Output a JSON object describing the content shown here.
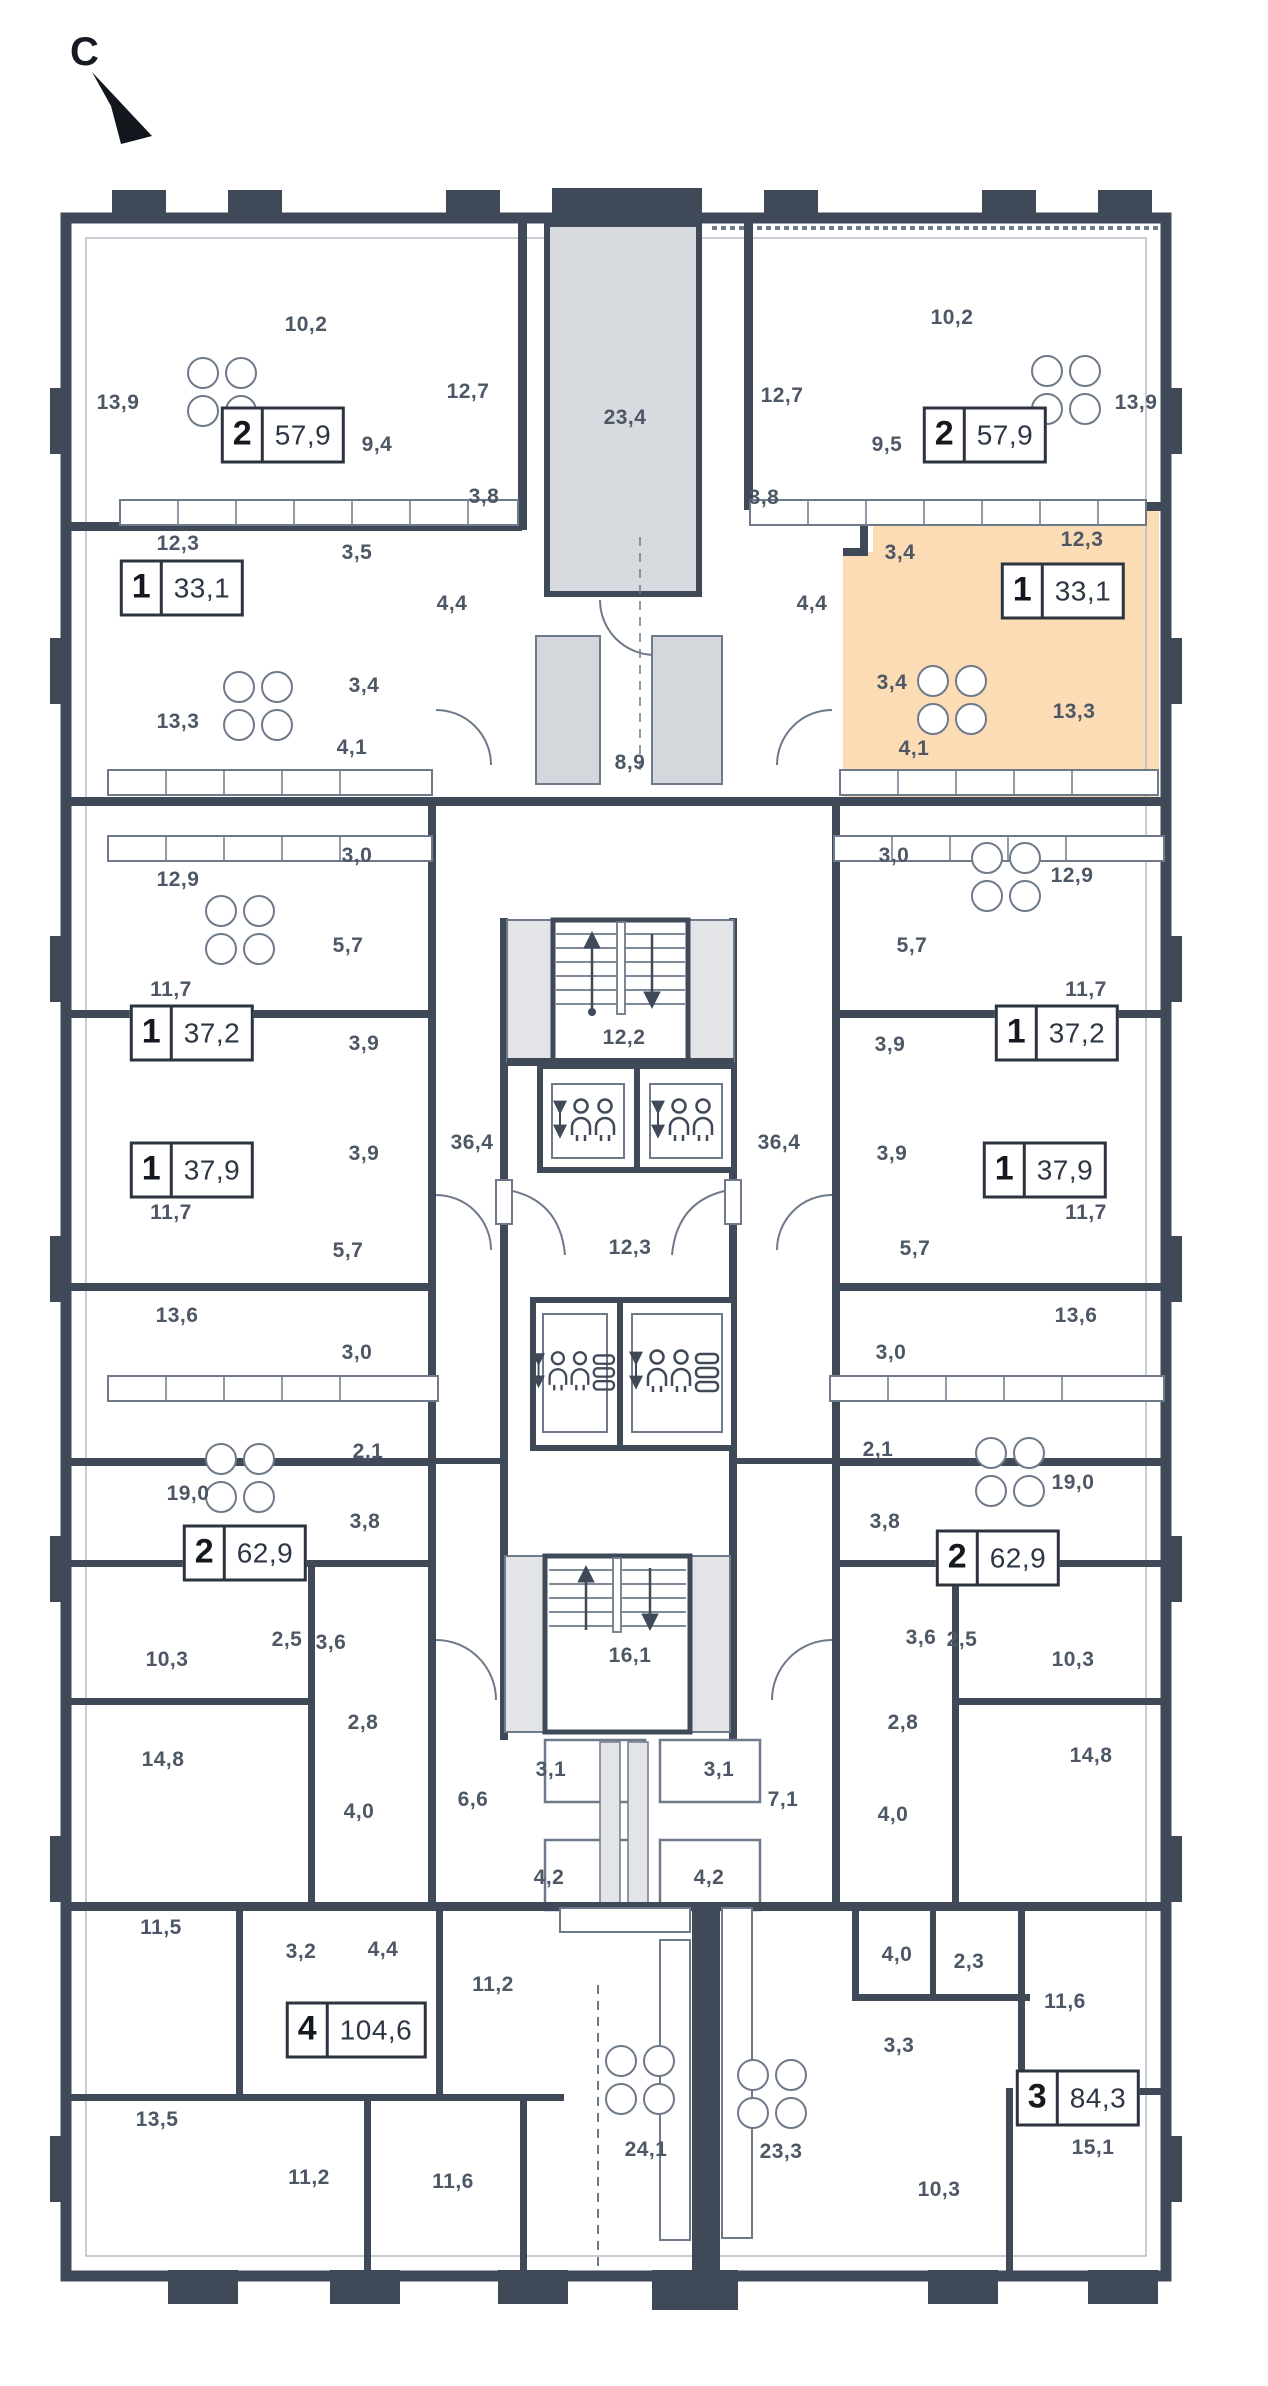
{
  "compass": {
    "letter": "С"
  },
  "colors": {
    "wall": "#3f4958",
    "line": "#6e7a8a",
    "gray_fill": "#d7dadf",
    "highlight": "#fcdcb4",
    "text": "#4d5765"
  },
  "plan": {
    "highlighted_apartment": {
      "rooms": "1",
      "area": "33,1"
    },
    "apartment_badges": [
      {
        "rooms": "2",
        "area": "57,9",
        "x": 283,
        "y": 435,
        "highlighted": false
      },
      {
        "rooms": "2",
        "area": "57,9",
        "x": 985,
        "y": 435,
        "highlighted": false
      },
      {
        "rooms": "1",
        "area": "33,1",
        "x": 182,
        "y": 588,
        "highlighted": false
      },
      {
        "rooms": "1",
        "area": "33,1",
        "x": 1063,
        "y": 591,
        "highlighted": true
      },
      {
        "rooms": "1",
        "area": "37,2",
        "x": 192,
        "y": 1033,
        "highlighted": false
      },
      {
        "rooms": "1",
        "area": "37,2",
        "x": 1057,
        "y": 1033,
        "highlighted": false
      },
      {
        "rooms": "1",
        "area": "37,9",
        "x": 192,
        "y": 1170,
        "highlighted": false
      },
      {
        "rooms": "1",
        "area": "37,9",
        "x": 1045,
        "y": 1170,
        "highlighted": false
      },
      {
        "rooms": "2",
        "area": "62,9",
        "x": 245,
        "y": 1553,
        "highlighted": false
      },
      {
        "rooms": "2",
        "area": "62,9",
        "x": 998,
        "y": 1558,
        "highlighted": false
      },
      {
        "rooms": "4",
        "area": "104,6",
        "x": 356,
        "y": 2030,
        "highlighted": false
      },
      {
        "rooms": "3",
        "area": "84,3",
        "x": 1078,
        "y": 2098,
        "highlighted": false
      }
    ],
    "room_labels": [
      {
        "t": "13,9",
        "x": 118,
        "y": 403
      },
      {
        "t": "10,2",
        "x": 306,
        "y": 325
      },
      {
        "t": "12,7",
        "x": 468,
        "y": 392
      },
      {
        "t": "23,4",
        "x": 625,
        "y": 418
      },
      {
        "t": "12,7",
        "x": 782,
        "y": 396
      },
      {
        "t": "10,2",
        "x": 952,
        "y": 318
      },
      {
        "t": "13,9",
        "x": 1136,
        "y": 403
      },
      {
        "t": "9,4",
        "x": 377,
        "y": 445
      },
      {
        "t": "9,5",
        "x": 887,
        "y": 445
      },
      {
        "t": "3,8",
        "x": 484,
        "y": 497
      },
      {
        "t": "3,8",
        "x": 764,
        "y": 498
      },
      {
        "t": "12,3",
        "x": 178,
        "y": 544
      },
      {
        "t": "3,5",
        "x": 357,
        "y": 553
      },
      {
        "t": "3,4",
        "x": 900,
        "y": 553
      },
      {
        "t": "12,3",
        "x": 1082,
        "y": 540
      },
      {
        "t": "4,4",
        "x": 452,
        "y": 604
      },
      {
        "t": "4,4",
        "x": 812,
        "y": 604
      },
      {
        "t": "3,4",
        "x": 364,
        "y": 686
      },
      {
        "t": "3,4",
        "x": 892,
        "y": 683
      },
      {
        "t": "13,3",
        "x": 178,
        "y": 722
      },
      {
        "t": "13,3",
        "x": 1074,
        "y": 712
      },
      {
        "t": "4,1",
        "x": 352,
        "y": 748
      },
      {
        "t": "4,1",
        "x": 914,
        "y": 749
      },
      {
        "t": "8,9",
        "x": 630,
        "y": 763
      },
      {
        "t": "3,0",
        "x": 357,
        "y": 856
      },
      {
        "t": "3,0",
        "x": 894,
        "y": 856
      },
      {
        "t": "12,9",
        "x": 178,
        "y": 880
      },
      {
        "t": "12,9",
        "x": 1072,
        "y": 876
      },
      {
        "t": "5,7",
        "x": 348,
        "y": 946
      },
      {
        "t": "5,7",
        "x": 912,
        "y": 946
      },
      {
        "t": "11,7",
        "x": 171,
        "y": 990
      },
      {
        "t": "11,7",
        "x": 1086,
        "y": 990
      },
      {
        "t": "3,9",
        "x": 364,
        "y": 1044
      },
      {
        "t": "3,9",
        "x": 890,
        "y": 1045
      },
      {
        "t": "12,2",
        "x": 624,
        "y": 1038
      },
      {
        "t": "36,4",
        "x": 472,
        "y": 1143
      },
      {
        "t": "36,4",
        "x": 779,
        "y": 1143
      },
      {
        "t": "3,9",
        "x": 364,
        "y": 1154
      },
      {
        "t": "3,9",
        "x": 892,
        "y": 1154
      },
      {
        "t": "11,7",
        "x": 171,
        "y": 1213
      },
      {
        "t": "11,7",
        "x": 1086,
        "y": 1213
      },
      {
        "t": "5,7",
        "x": 348,
        "y": 1251
      },
      {
        "t": "5,7",
        "x": 915,
        "y": 1249
      },
      {
        "t": "12,3",
        "x": 630,
        "y": 1248
      },
      {
        "t": "13,6",
        "x": 177,
        "y": 1316
      },
      {
        "t": "13,6",
        "x": 1076,
        "y": 1316
      },
      {
        "t": "3,0",
        "x": 357,
        "y": 1353
      },
      {
        "t": "3,0",
        "x": 891,
        "y": 1353
      },
      {
        "t": "2,1",
        "x": 368,
        "y": 1452
      },
      {
        "t": "2,1",
        "x": 878,
        "y": 1450
      },
      {
        "t": "19,0",
        "x": 188,
        "y": 1494
      },
      {
        "t": "19,0",
        "x": 1073,
        "y": 1483
      },
      {
        "t": "3,8",
        "x": 365,
        "y": 1522
      },
      {
        "t": "3,8",
        "x": 885,
        "y": 1522
      },
      {
        "t": "2,5",
        "x": 287,
        "y": 1640
      },
      {
        "t": "2,5",
        "x": 962,
        "y": 1640
      },
      {
        "t": "3,6",
        "x": 331,
        "y": 1643
      },
      {
        "t": "3,6",
        "x": 921,
        "y": 1638
      },
      {
        "t": "10,3",
        "x": 167,
        "y": 1660
      },
      {
        "t": "10,3",
        "x": 1073,
        "y": 1660
      },
      {
        "t": "16,1",
        "x": 630,
        "y": 1656
      },
      {
        "t": "2,8",
        "x": 363,
        "y": 1723
      },
      {
        "t": "2,8",
        "x": 903,
        "y": 1723
      },
      {
        "t": "14,8",
        "x": 163,
        "y": 1760
      },
      {
        "t": "14,8",
        "x": 1091,
        "y": 1756
      },
      {
        "t": "3,1",
        "x": 551,
        "y": 1770
      },
      {
        "t": "3,1",
        "x": 719,
        "y": 1770
      },
      {
        "t": "6,6",
        "x": 473,
        "y": 1800
      },
      {
        "t": "7,1",
        "x": 783,
        "y": 1800
      },
      {
        "t": "4,0",
        "x": 359,
        "y": 1812
      },
      {
        "t": "4,0",
        "x": 893,
        "y": 1815
      },
      {
        "t": "4,2",
        "x": 549,
        "y": 1878
      },
      {
        "t": "4,2",
        "x": 709,
        "y": 1878
      },
      {
        "t": "11,5",
        "x": 161,
        "y": 1928
      },
      {
        "t": "3,2",
        "x": 301,
        "y": 1952
      },
      {
        "t": "4,4",
        "x": 383,
        "y": 1950
      },
      {
        "t": "4,0",
        "x": 897,
        "y": 1955
      },
      {
        "t": "2,3",
        "x": 969,
        "y": 1962
      },
      {
        "t": "11,2",
        "x": 493,
        "y": 1985
      },
      {
        "t": "11,6",
        "x": 1065,
        "y": 2002
      },
      {
        "t": "3,3",
        "x": 899,
        "y": 2046
      },
      {
        "t": "13,5",
        "x": 157,
        "y": 2120
      },
      {
        "t": "15,1",
        "x": 1093,
        "y": 2148
      },
      {
        "t": "24,1",
        "x": 646,
        "y": 2150
      },
      {
        "t": "23,3",
        "x": 781,
        "y": 2152
      },
      {
        "t": "11,2",
        "x": 309,
        "y": 2178
      },
      {
        "t": "11,6",
        "x": 453,
        "y": 2182
      },
      {
        "t": "10,3",
        "x": 939,
        "y": 2190
      }
    ]
  }
}
